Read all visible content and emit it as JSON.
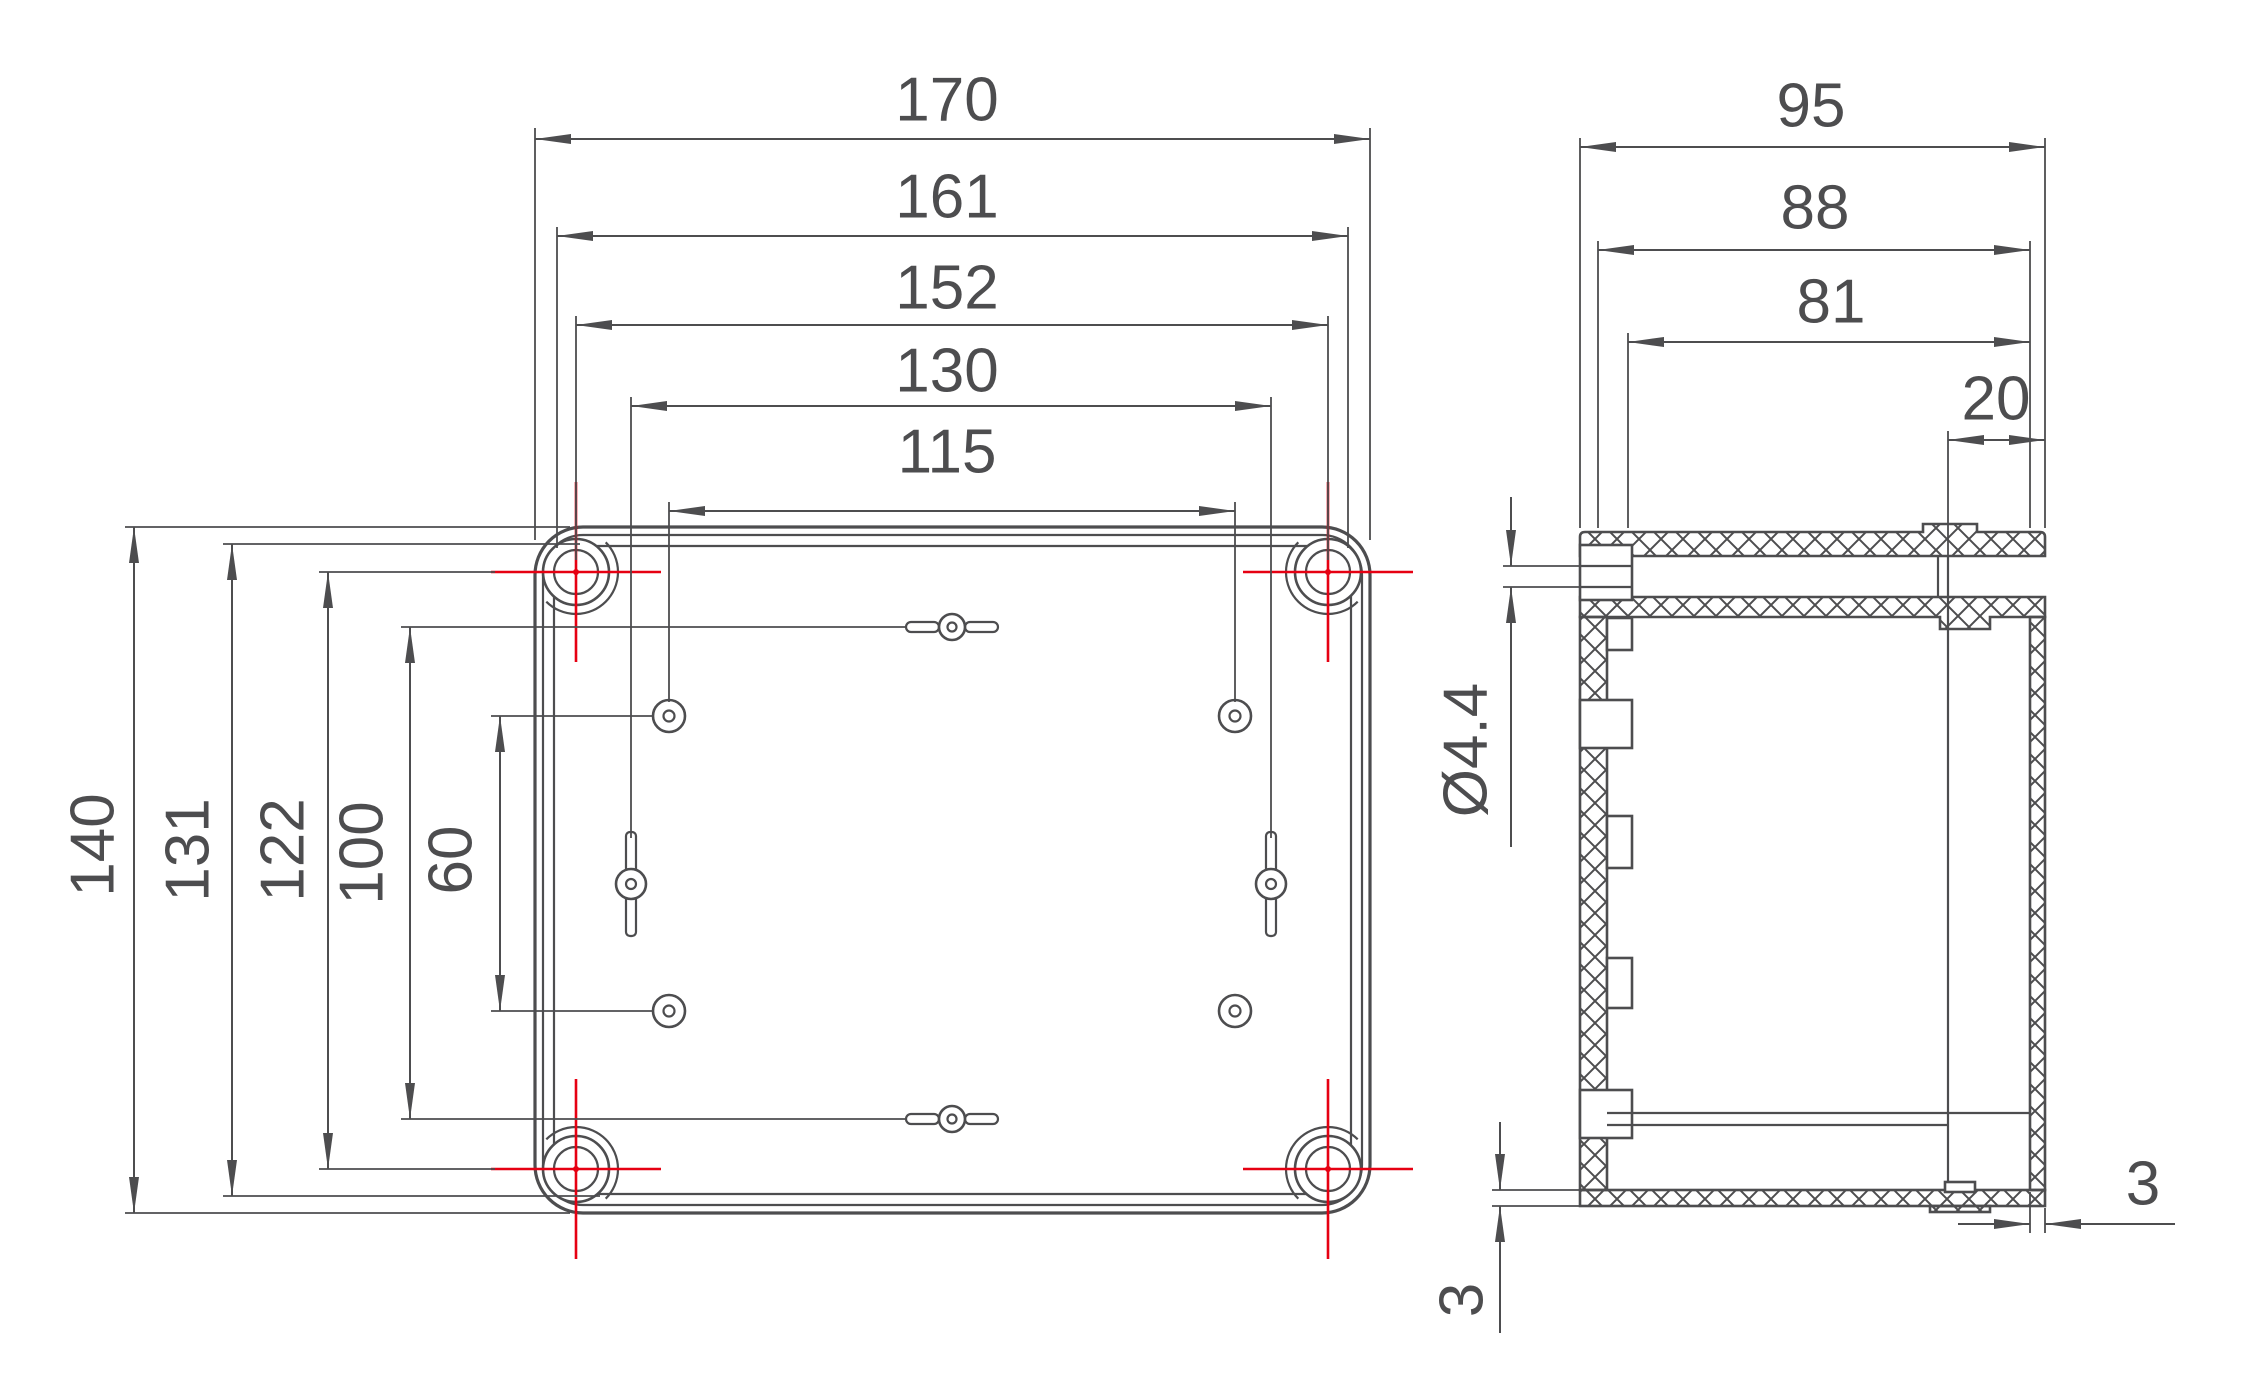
{
  "drawing": {
    "kind": "enclosure-dimension-drawing",
    "colors": {
      "line": "#4d4d4f",
      "centerline_red": "#e60012",
      "background": "#ffffff"
    },
    "plan_view": {
      "horizontal": {
        "outer_width": "170",
        "lid_width": "161",
        "screw_spacing": "152",
        "keyhole_spacing": "130",
        "hole_spacing": "115"
      },
      "vertical": {
        "outer_height": "140",
        "lid_height": "131",
        "screw_spacing": "122",
        "center_hole_spacing": "100",
        "hole_spacing": "60"
      }
    },
    "side_view": {
      "overall_depth": "95",
      "lid_depth": "88",
      "inner_depth": "81",
      "cover_height": "20",
      "screw_hole_diameter": "Ø4.4",
      "base_thickness": "3",
      "side_wall_thickness": "3"
    }
  }
}
